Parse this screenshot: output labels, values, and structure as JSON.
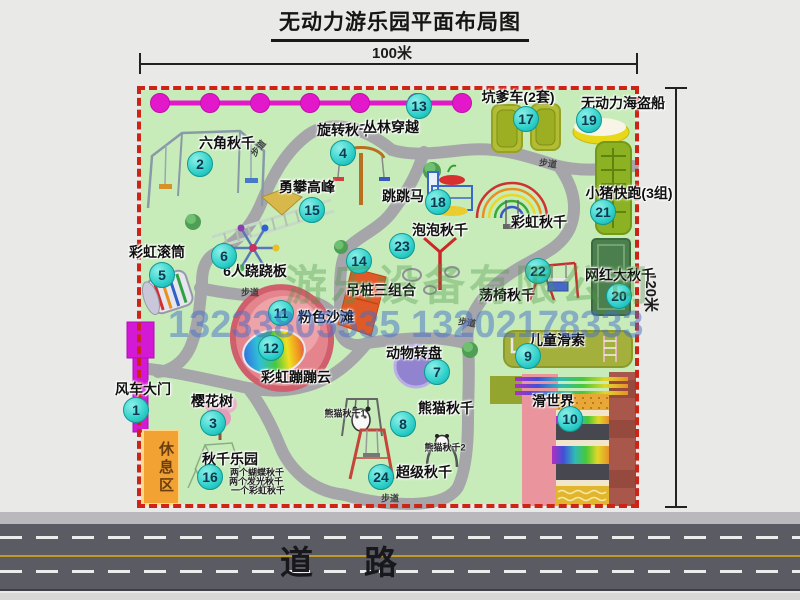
{
  "title": "无动力游乐园平面布局图",
  "dimensions": {
    "top": "100米",
    "right": "120米"
  },
  "road_label": "道　路",
  "rest_area_label": "休息区",
  "watermark": {
    "company": "游乐设备有限公司",
    "phone": "13233805535 13202178333"
  },
  "path_label_text": "步道",
  "path_labels": [
    {
      "x": 258,
      "y": 148,
      "rot": -50
    },
    {
      "x": 548,
      "y": 163,
      "rot": 8
    },
    {
      "x": 250,
      "y": 292,
      "rot": 0
    },
    {
      "x": 467,
      "y": 322,
      "rot": 8
    },
    {
      "x": 390,
      "y": 498,
      "rot": 0
    }
  ],
  "colors": {
    "map_bg": "#c7ecba",
    "border_red": "#ce2418",
    "marker_fill": "#2fd0ca",
    "chain_magenta": "#e318ca",
    "road_gray": "#5b5b64",
    "path_gray": "#a6a6aa"
  },
  "items": [
    {
      "id": "windmill-gate",
      "num": "1",
      "label": "风车大门",
      "cx": 136,
      "cy": 410,
      "lx": 143,
      "ly": 389
    },
    {
      "id": "hexagon-swing",
      "num": "2",
      "label": "六角秋千",
      "cx": 200,
      "cy": 164,
      "lx": 227,
      "ly": 143
    },
    {
      "id": "cherry-tree",
      "num": "3",
      "label": "樱花树",
      "cx": 213,
      "cy": 423,
      "lx": 212,
      "ly": 401
    },
    {
      "id": "rotary-swing",
      "num": "4",
      "label": "旋转秋千",
      "cx": 343,
      "cy": 153,
      "lx": 345,
      "ly": 130
    },
    {
      "id": "rainbow-roller",
      "num": "5",
      "label": "彩虹滚筒",
      "cx": 162,
      "cy": 275,
      "lx": 157,
      "ly": 252
    },
    {
      "id": "six-seesaw",
      "num": "6",
      "label": "6人跷跷板",
      "cx": 224,
      "cy": 256,
      "lx": 255,
      "ly": 271
    },
    {
      "id": "animal-turntable",
      "num": "7",
      "label": "动物转盘",
      "cx": 437,
      "cy": 372,
      "lx": 414,
      "ly": 353
    },
    {
      "id": "panda-swing",
      "num": "8",
      "label": "熊猫秋千",
      "cx": 403,
      "cy": 424,
      "lx": 446,
      "ly": 408,
      "subs": [
        {
          "text": "熊猫秋千1",
          "x": 345,
          "y": 413
        },
        {
          "text": "熊猫秋千2",
          "x": 445,
          "y": 447
        }
      ]
    },
    {
      "id": "kids-zipline",
      "num": "9",
      "label": "儿童滑索",
      "cx": 528,
      "cy": 356,
      "lx": 557,
      "ly": 340
    },
    {
      "id": "slide-world",
      "num": "10",
      "label": "滑世界",
      "cx": 570,
      "cy": 419,
      "lx": 553,
      "ly": 401
    },
    {
      "id": "pink-beach",
      "num": "11",
      "label": "粉色沙滩",
      "cx": 281,
      "cy": 313,
      "lx": 326,
      "ly": 317
    },
    {
      "id": "rainbow-cloud",
      "num": "12",
      "label": "彩虹蹦蹦云",
      "cx": 271,
      "cy": 348,
      "lx": 296,
      "ly": 377
    },
    {
      "id": "jungle-crossing",
      "num": "13",
      "label": "丛林穿越",
      "cx": 419,
      "cy": 106,
      "lx": 391,
      "ly": 127
    },
    {
      "id": "hanging-piles",
      "num": "14",
      "label": "吊桩三组合",
      "cx": 359,
      "cy": 261,
      "lx": 381,
      "ly": 290
    },
    {
      "id": "peak-climbing",
      "num": "15",
      "label": "勇攀高峰",
      "cx": 312,
      "cy": 210,
      "lx": 307,
      "ly": 187
    },
    {
      "id": "swing-park",
      "num": "16",
      "label": "秋千乐园",
      "cx": 210,
      "cy": 477,
      "lx": 230,
      "ly": 459,
      "subs": [
        {
          "text": "两个蝴蝶秋千",
          "x": 257,
          "y": 472
        },
        {
          "text": "两个发光秋千",
          "x": 256,
          "y": 481
        },
        {
          "text": "一个彩虹秋千",
          "x": 258,
          "y": 490
        }
      ]
    },
    {
      "id": "pit-cars",
      "num": "17",
      "label": "坑爹车(2套)",
      "cx": 526,
      "cy": 119,
      "lx": 518,
      "ly": 97
    },
    {
      "id": "jumping-horse",
      "num": "18",
      "label": "跳跳马",
      "cx": 438,
      "cy": 202,
      "lx": 403,
      "ly": 196
    },
    {
      "id": "pirate-ship",
      "num": "19",
      "label": "无动力海盗船",
      "cx": 589,
      "cy": 120,
      "lx": 623,
      "ly": 103
    },
    {
      "id": "big-swing",
      "num": "20",
      "label": "网红大秋千",
      "cx": 619,
      "cy": 296,
      "lx": 620,
      "ly": 275
    },
    {
      "id": "piggy-run",
      "num": "21",
      "label": "小猪快跑(3组)",
      "cx": 603,
      "cy": 212,
      "lx": 629,
      "ly": 193
    },
    {
      "id": "chair-swing",
      "num": "22",
      "label": "荡椅秋千",
      "cx": 538,
      "cy": 271,
      "lx": 507,
      "ly": 295
    },
    {
      "id": "bubble-swing",
      "num": "23",
      "label": "泡泡秋千",
      "cx": 402,
      "cy": 246,
      "lx": 440,
      "ly": 230
    },
    {
      "id": "super-swing",
      "num": "24",
      "label": "超级秋千",
      "cx": 381,
      "cy": 477,
      "lx": 424,
      "ly": 472
    },
    {
      "id": "rainbow-swing",
      "num": null,
      "label": "彩虹秋千",
      "cx": null,
      "cy": null,
      "lx": 539,
      "ly": 222
    }
  ]
}
